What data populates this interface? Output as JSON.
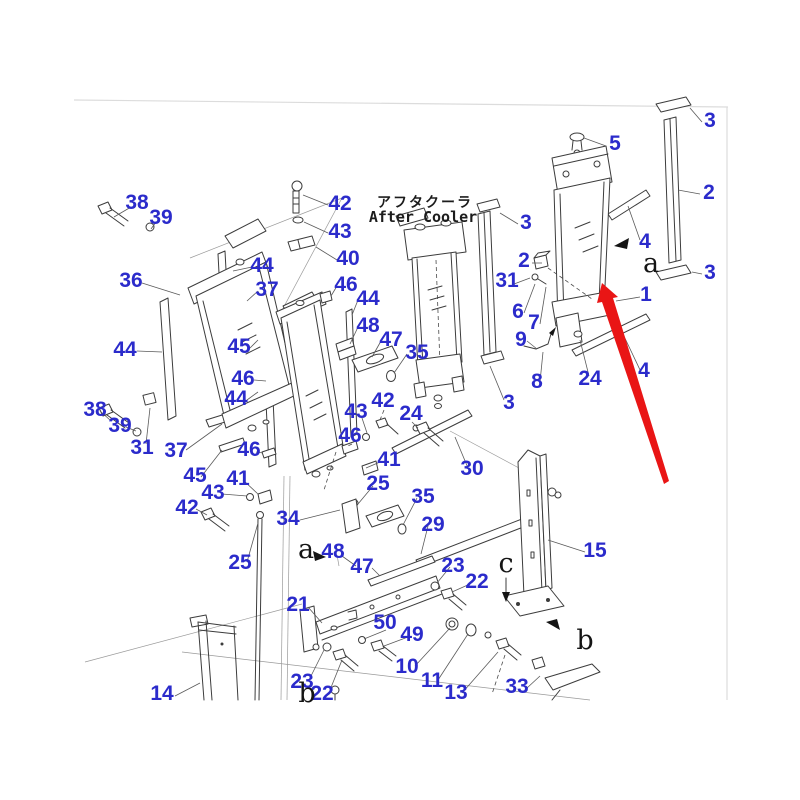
{
  "colors": {
    "label_blue": "#2b2bcb",
    "arrow_red": "#e91515",
    "line_dark": "#3c3c3c",
    "leader_gray": "#5a5a5a"
  },
  "title": {
    "jp": "アフタクーラ",
    "en": "After Cooler"
  },
  "highlighted_part": "1",
  "view_letters": [
    {
      "text": "a",
      "x": 651,
      "y": 272
    },
    {
      "text": "a",
      "x": 306,
      "y": 558
    },
    {
      "text": "b",
      "x": 585,
      "y": 649
    },
    {
      "text": "b",
      "x": 307,
      "y": 702
    },
    {
      "text": "c",
      "x": 506,
      "y": 572
    }
  ],
  "part_labels": [
    {
      "text": "38",
      "x": 137,
      "y": 209
    },
    {
      "text": "39",
      "x": 161,
      "y": 224
    },
    {
      "text": "42",
      "x": 340,
      "y": 210
    },
    {
      "text": "43",
      "x": 340,
      "y": 238
    },
    {
      "text": "40",
      "x": 348,
      "y": 265
    },
    {
      "text": "44",
      "x": 262,
      "y": 272
    },
    {
      "text": "36",
      "x": 131,
      "y": 287
    },
    {
      "text": "37",
      "x": 267,
      "y": 296
    },
    {
      "text": "46",
      "x": 346,
      "y": 291
    },
    {
      "text": "44",
      "x": 368,
      "y": 305
    },
    {
      "text": "48",
      "x": 368,
      "y": 332
    },
    {
      "text": "47",
      "x": 391,
      "y": 346
    },
    {
      "text": "35",
      "x": 417,
      "y": 359
    },
    {
      "text": "44",
      "x": 125,
      "y": 356
    },
    {
      "text": "45",
      "x": 239,
      "y": 353
    },
    {
      "text": "46",
      "x": 243,
      "y": 385
    },
    {
      "text": "44",
      "x": 236,
      "y": 405
    },
    {
      "text": "38",
      "x": 95,
      "y": 416
    },
    {
      "text": "39",
      "x": 120,
      "y": 432
    },
    {
      "text": "31",
      "x": 142,
      "y": 454
    },
    {
      "text": "37",
      "x": 176,
      "y": 457
    },
    {
      "text": "45",
      "x": 195,
      "y": 482
    },
    {
      "text": "46",
      "x": 249,
      "y": 456
    },
    {
      "text": "41",
      "x": 238,
      "y": 485
    },
    {
      "text": "43",
      "x": 213,
      "y": 499
    },
    {
      "text": "42",
      "x": 187,
      "y": 514
    },
    {
      "text": "25",
      "x": 240,
      "y": 569
    },
    {
      "text": "34",
      "x": 288,
      "y": 525
    },
    {
      "text": "43",
      "x": 356,
      "y": 418
    },
    {
      "text": "42",
      "x": 383,
      "y": 407
    },
    {
      "text": "24",
      "x": 411,
      "y": 420
    },
    {
      "text": "46",
      "x": 350,
      "y": 442
    },
    {
      "text": "41",
      "x": 389,
      "y": 466
    },
    {
      "text": "25",
      "x": 378,
      "y": 490
    },
    {
      "text": "35",
      "x": 423,
      "y": 503
    },
    {
      "text": "29",
      "x": 433,
      "y": 531
    },
    {
      "text": "48",
      "x": 333,
      "y": 558
    },
    {
      "text": "47",
      "x": 362,
      "y": 573
    },
    {
      "text": "30",
      "x": 472,
      "y": 475
    },
    {
      "text": "21",
      "x": 298,
      "y": 611
    },
    {
      "text": "50",
      "x": 385,
      "y": 629
    },
    {
      "text": "49",
      "x": 412,
      "y": 641
    },
    {
      "text": "10",
      "x": 407,
      "y": 673
    },
    {
      "text": "11",
      "x": 432,
      "y": 687
    },
    {
      "text": "13",
      "x": 456,
      "y": 699
    },
    {
      "text": "23",
      "x": 453,
      "y": 572
    },
    {
      "text": "22",
      "x": 477,
      "y": 588
    },
    {
      "text": "23",
      "x": 302,
      "y": 688
    },
    {
      "text": "22",
      "x": 322,
      "y": 700
    },
    {
      "text": "33",
      "x": 517,
      "y": 693
    },
    {
      "text": "15",
      "x": 595,
      "y": 557
    },
    {
      "text": "14",
      "x": 162,
      "y": 700
    },
    {
      "text": "5",
      "x": 615,
      "y": 150
    },
    {
      "text": "3",
      "x": 710,
      "y": 127
    },
    {
      "text": "2",
      "x": 709,
      "y": 199
    },
    {
      "text": "3",
      "x": 710,
      "y": 279
    },
    {
      "text": "4",
      "x": 645,
      "y": 248
    },
    {
      "text": "3",
      "x": 526,
      "y": 229
    },
    {
      "text": "2",
      "x": 524,
      "y": 267
    },
    {
      "text": "31",
      "x": 507,
      "y": 287
    },
    {
      "text": "1",
      "x": 646,
      "y": 301
    },
    {
      "text": "6",
      "x": 518,
      "y": 318
    },
    {
      "text": "7",
      "x": 534,
      "y": 329
    },
    {
      "text": "9",
      "x": 521,
      "y": 346
    },
    {
      "text": "8",
      "x": 537,
      "y": 388
    },
    {
      "text": "24",
      "x": 590,
      "y": 385
    },
    {
      "text": "4",
      "x": 644,
      "y": 377
    },
    {
      "text": "3",
      "x": 509,
      "y": 409
    }
  ]
}
